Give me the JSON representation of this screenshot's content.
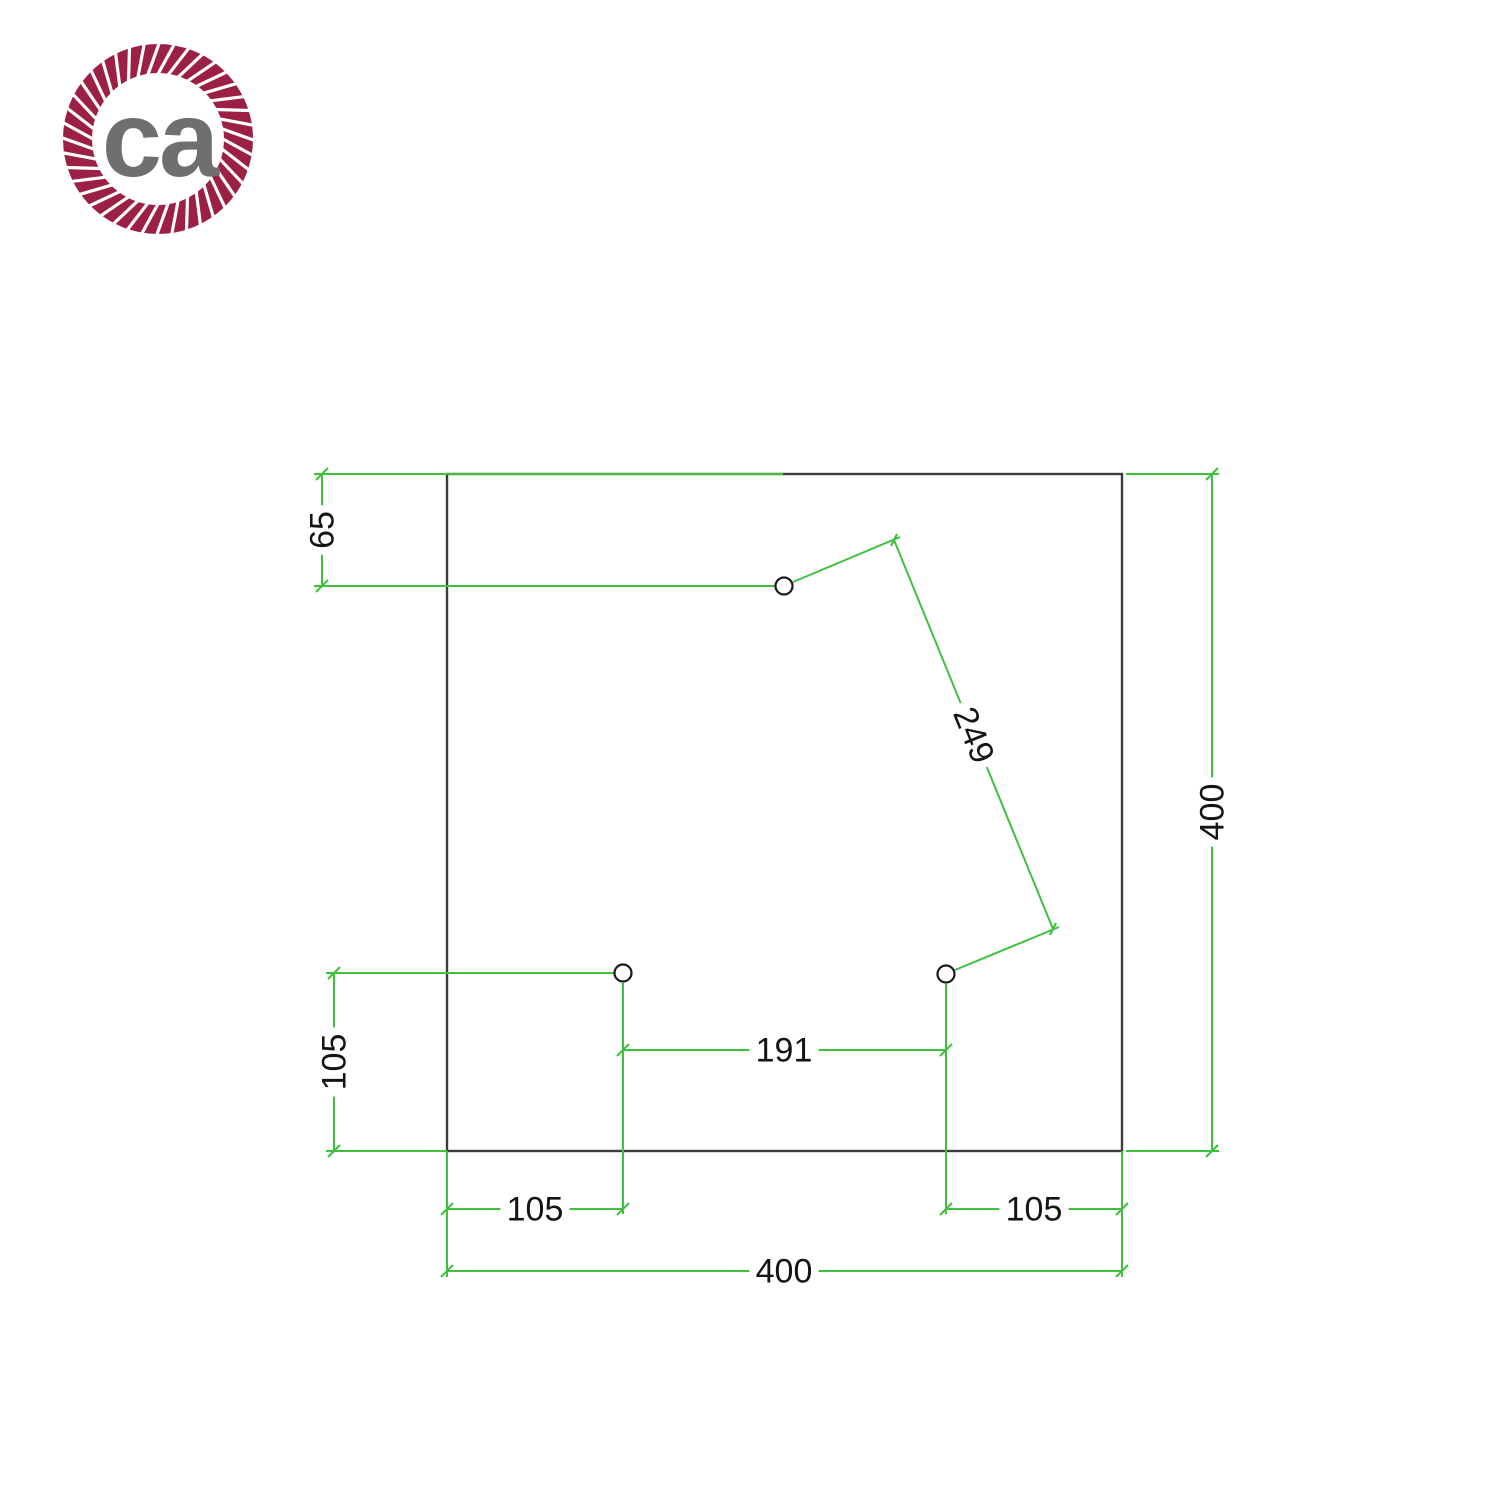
{
  "page": {
    "background": "#ffffff"
  },
  "logo": {
    "text": "ca",
    "ring_color": "#9b2044",
    "text_color": "#6f6f6f",
    "cx": 158,
    "cy": 139,
    "outer_r": 95,
    "inner_r": 66,
    "strand_count": 40,
    "strand_tilt": 0.17,
    "font_size": 108
  },
  "drawing": {
    "line_color": "#3fc03f",
    "outline_color": "#3c3c3c",
    "hole_stroke": "#1a1a1a",
    "text_color": "#141414",
    "font_size": 34,
    "plate": {
      "x": 447,
      "y": 474,
      "width": 675,
      "height": 677
    },
    "holes": [
      {
        "cx": 784,
        "cy": 586,
        "r": 8.5
      },
      {
        "cx": 623,
        "cy": 973,
        "r": 8.5
      },
      {
        "cx": 946,
        "cy": 974,
        "r": 8.5
      }
    ],
    "lines": [
      [
        322,
        474,
        322,
        586
      ],
      [
        314,
        474,
        783,
        474
      ],
      [
        314,
        586,
        775,
        586
      ],
      [
        334,
        973,
        334,
        1151
      ],
      [
        326,
        973,
        614,
        973
      ],
      [
        326,
        1151,
        447,
        1151
      ],
      [
        1212,
        474,
        1212,
        1151
      ],
      [
        1126,
        474,
        1219,
        474
      ],
      [
        1126,
        1151,
        1219,
        1151
      ],
      [
        894,
        540,
        1053,
        929
      ],
      [
        793,
        582,
        900,
        537
      ],
      [
        955,
        970,
        1059,
        927
      ],
      [
        623,
        1050,
        946,
        1050
      ],
      [
        623,
        983,
        623,
        1214
      ],
      [
        946,
        984,
        946,
        1214
      ],
      [
        447,
        1209,
        623,
        1209
      ],
      [
        447,
        1151,
        447,
        1277
      ],
      [
        946,
        1209,
        1122,
        1209
      ],
      [
        1122,
        1151,
        1122,
        1277
      ],
      [
        447,
        1271,
        1122,
        1271
      ]
    ],
    "ticks": [
      [
        316,
        480,
        328,
        468
      ],
      [
        316,
        592,
        328,
        580
      ],
      [
        328,
        979,
        340,
        967
      ],
      [
        328,
        1157,
        340,
        1145
      ],
      [
        1206,
        480,
        1218,
        468
      ],
      [
        1206,
        1157,
        1218,
        1145
      ],
      [
        617,
        1056,
        629,
        1044
      ],
      [
        940,
        1056,
        952,
        1044
      ],
      [
        441,
        1215,
        453,
        1203
      ],
      [
        617,
        1215,
        629,
        1203
      ],
      [
        940,
        1215,
        952,
        1203
      ],
      [
        1116,
        1215,
        1128,
        1203
      ],
      [
        441,
        1277,
        453,
        1265
      ],
      [
        1116,
        1277,
        1128,
        1265
      ],
      [
        897,
        534,
        891,
        546
      ],
      [
        1056,
        923,
        1050,
        935
      ]
    ],
    "labels": [
      {
        "text": "65",
        "x": 322,
        "y": 530,
        "rot": -90
      },
      {
        "text": "105",
        "x": 334,
        "y": 1062,
        "rot": -90
      },
      {
        "text": "400",
        "x": 1212,
        "y": 812,
        "rot": -90
      },
      {
        "text": "249",
        "x": 974,
        "y": 735,
        "rot": 68
      },
      {
        "text": "191",
        "x": 784,
        "y": 1050,
        "rot": 0
      },
      {
        "text": "105",
        "x": 535,
        "y": 1209,
        "rot": 0
      },
      {
        "text": "105",
        "x": 1034,
        "y": 1209,
        "rot": 0
      },
      {
        "text": "400",
        "x": 784,
        "y": 1271,
        "rot": 0
      }
    ]
  }
}
